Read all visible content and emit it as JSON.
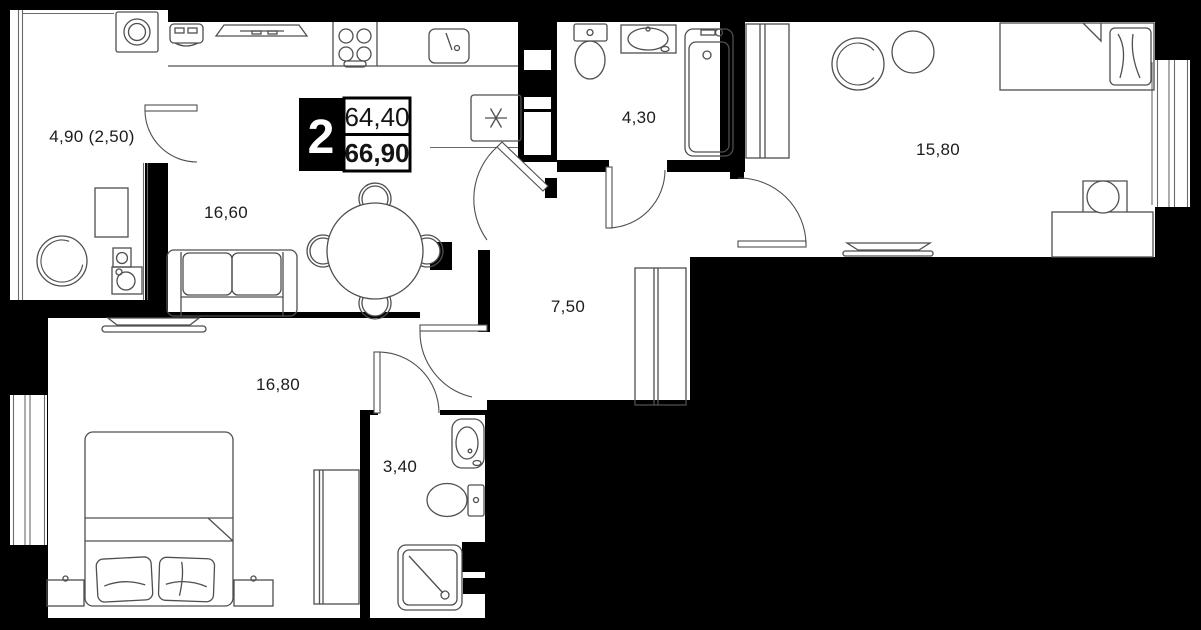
{
  "plan": {
    "badge": {
      "rooms_count": "2",
      "total_area": "64,40",
      "living_area": "66,90"
    },
    "rooms": {
      "loggia": {
        "label": "4,90 (2,50)",
        "furniture": [
          "washing-machine",
          "armchair",
          "side-table",
          "speakers"
        ]
      },
      "kitchen_living": {
        "label": "16,60",
        "furniture": [
          "coffee-machine",
          "hood",
          "cooktop",
          "sink",
          "fridge",
          "sofa",
          "dining-table",
          "chairs"
        ]
      },
      "bathroom": {
        "label": "4,30",
        "furniture": [
          "toilet",
          "washbasin",
          "bathtub"
        ]
      },
      "bedroom_right": {
        "label": "15,80",
        "furniture": [
          "wardrobe",
          "armchair",
          "side-table",
          "single-bed",
          "desk",
          "desk-chair",
          "tv"
        ]
      },
      "hallway": {
        "label": "7,50",
        "furniture": [
          "wardrobe"
        ]
      },
      "bedroom_left": {
        "label": "16,80",
        "furniture": [
          "tv",
          "double-bed",
          "nightstands",
          "wardrobe"
        ]
      },
      "wc": {
        "label": "3,40",
        "furniture": [
          "washbasin",
          "toilet",
          "shower"
        ]
      }
    },
    "colors": {
      "wall": "#000000",
      "floor": "#ffffff",
      "furniture_line": "#4f4f4f",
      "badge_bg": "#000000",
      "badge_text": "#ffffff"
    }
  }
}
